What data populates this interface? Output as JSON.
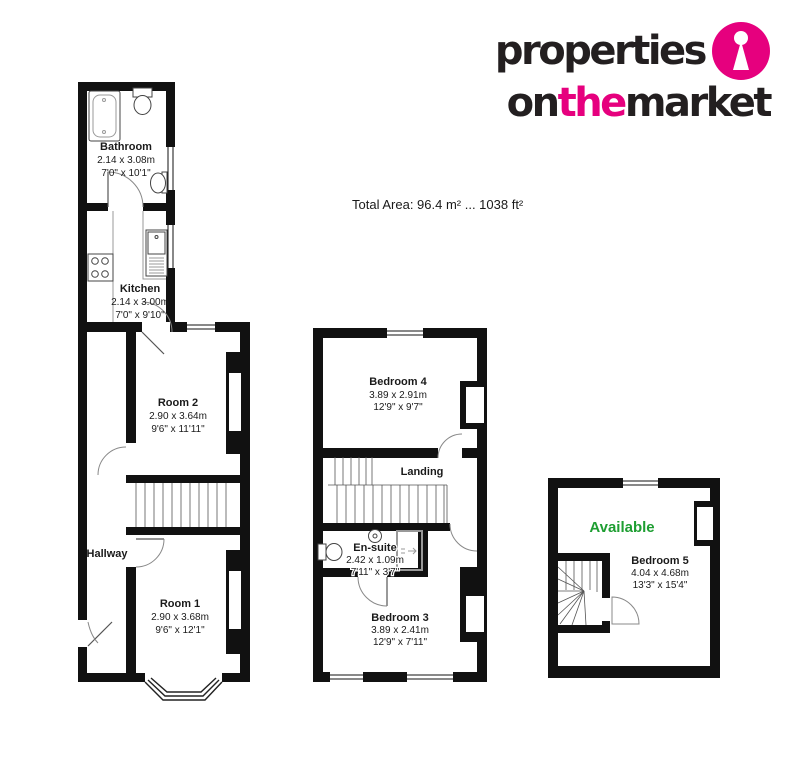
{
  "logo": {
    "word1": "properties",
    "on": "on",
    "the": "the",
    "market": "market",
    "brand_pink": "#E6007E",
    "brand_black": "#231F20",
    "icon": "keyhole-icon"
  },
  "header": {
    "total_area": "Total Area: 96.4 m² ... 1038 ft²"
  },
  "ground_floor": {
    "bathroom": {
      "name": "Bathroom",
      "metric": "2.14 x 3.08m",
      "imperial": "7'0\" x 10'1\""
    },
    "kitchen": {
      "name": "Kitchen",
      "metric": "2.14 x 3.00m",
      "imperial": "7'0\" x 9'10\""
    },
    "room2": {
      "name": "Room 2",
      "metric": "2.90 x 3.64m",
      "imperial": "9'6\" x 11'11\""
    },
    "hallway": {
      "name": "Hallway"
    },
    "room1": {
      "name": "Room 1",
      "metric": "2.90 x 3.68m",
      "imperial": "9'6\" x 12'1\""
    }
  },
  "first_floor": {
    "bedroom4": {
      "name": "Bedroom 4",
      "metric": "3.89 x 2.91m",
      "imperial": "12'9\" x 9'7\""
    },
    "landing": {
      "name": "Landing"
    },
    "ensuite": {
      "name": "En-suite",
      "metric": "2.42 x 1.09m",
      "imperial": "7'11\" x 3'7\""
    },
    "bedroom3": {
      "name": "Bedroom 3",
      "metric": "3.89 x 2.41m",
      "imperial": "12'9\" x 7'11\""
    }
  },
  "second_floor": {
    "status": "Available",
    "bedroom5": {
      "name": "Bedroom 5",
      "metric": "4.04 x 4.68m",
      "imperial": "13'3\" x 15'4\""
    }
  },
  "colors": {
    "wall": "#111111",
    "available_green": "#1E9E32",
    "brand_pink": "#E6007E"
  }
}
